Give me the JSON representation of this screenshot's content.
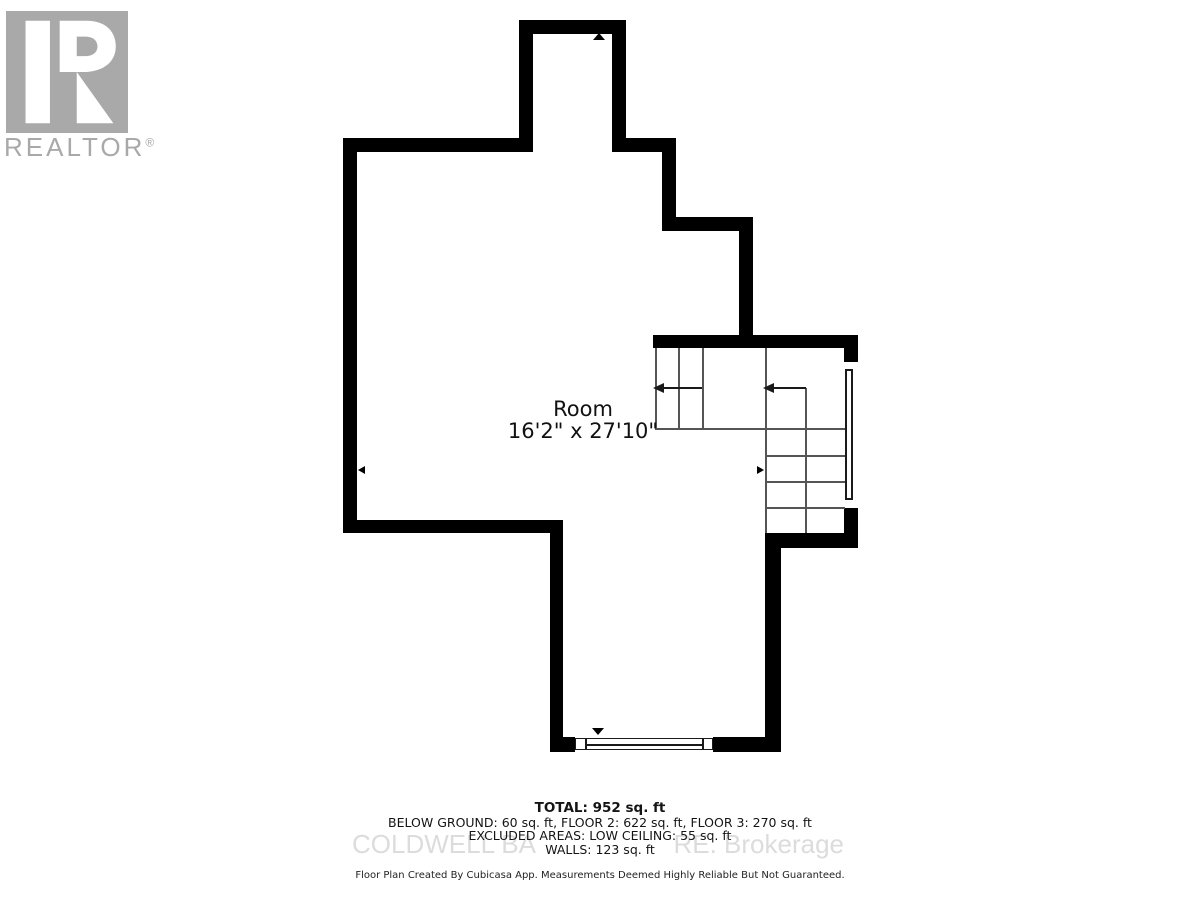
{
  "branding": {
    "realtor_logo_text": "REALTOR",
    "registered_mark": "®",
    "logo_letter": "R"
  },
  "room": {
    "name": "Room",
    "dimensions": "16'2\" x 27'10\""
  },
  "summary": {
    "total": "TOTAL: 952 sq. ft",
    "floors": "BELOW GROUND: 60 sq. ft, FLOOR 2: 622 sq. ft, FLOOR 3: 270 sq. ft",
    "excluded": "EXCLUDED AREAS: LOW CEILING: 55 sq. ft",
    "walls": "WALLS: 123 sq. ft"
  },
  "watermark": {
    "left": "COLDWELL BA",
    "right": "RE. Brokerage"
  },
  "footer": {
    "disclaimer": "Floor Plan Created By Cubicasa App. Measurements Deemed Highly Reliable But Not Guaranteed."
  },
  "colors": {
    "wall": "#000000",
    "stair_line": "#555555",
    "logo_gray": "#a9a9a9",
    "watermark_gray": "#dcdcdc",
    "text": "#111111"
  }
}
